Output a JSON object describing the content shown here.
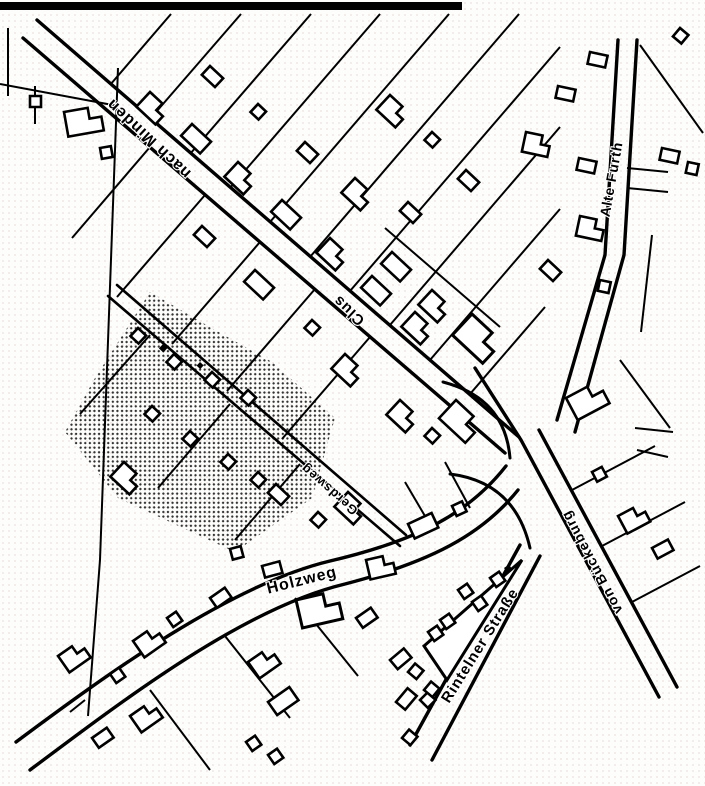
{
  "map": {
    "streets": {
      "nach_minden": {
        "label": "nach Minden"
      },
      "clus": {
        "label": "Clus"
      },
      "alte_furth": {
        "label": "Alte Furth"
      },
      "gerdsweg": {
        "label": "Gerdsweg"
      },
      "holzweg": {
        "label": "Holzweg"
      },
      "rintelner_strasse": {
        "label": "Rintelner Straße"
      },
      "von_bueckeburg": {
        "label": "von Bückeburg"
      }
    },
    "colors": {
      "ink": "#000000",
      "paper": "#ffffff"
    }
  }
}
